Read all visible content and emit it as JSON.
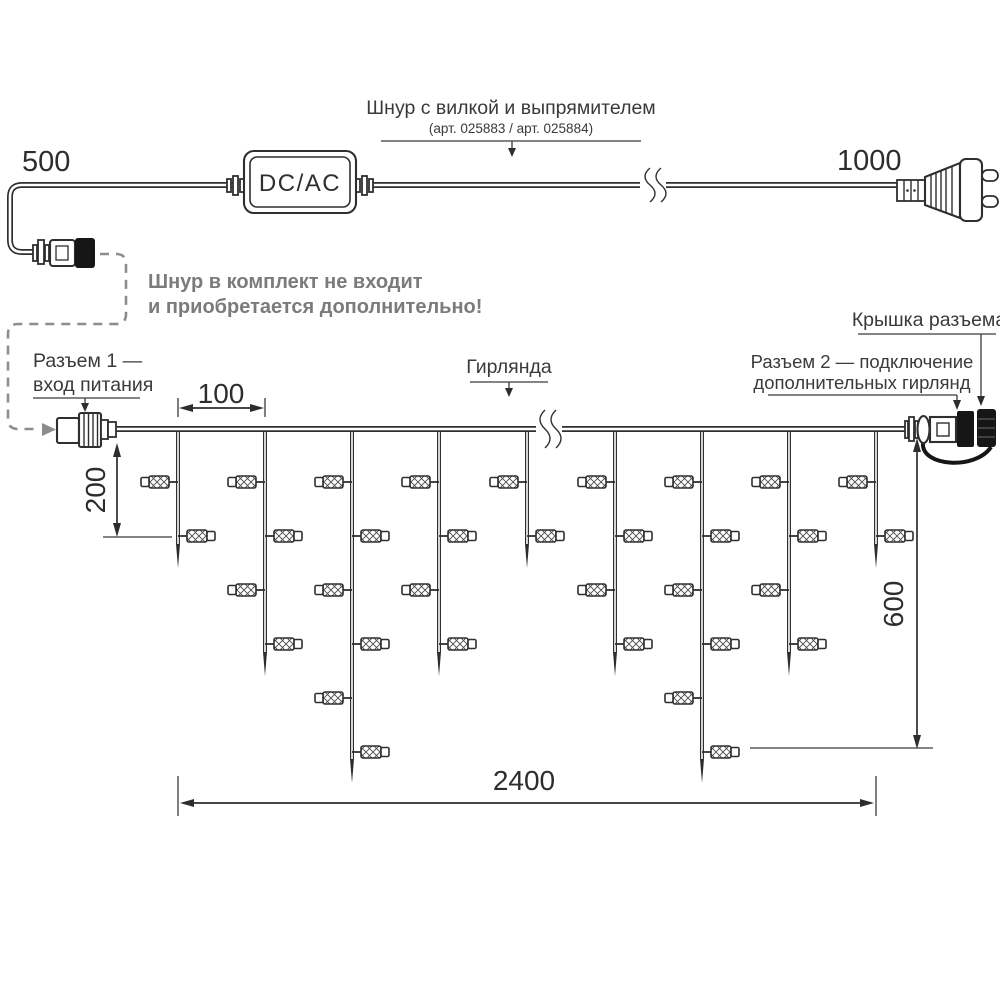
{
  "labels": {
    "cord_title": "Шнур с вилкой и выпрямителем",
    "cord_articles": "(арт. 025883 / арт. 025884)",
    "adapter": "DC/AC",
    "note_line1": "Шнур в комплект не входит",
    "note_line2": "и приобретается дополнительно!",
    "connector1_line1": "Разъем 1 —",
    "connector1_line2": "вход питания",
    "garland": "Гирлянда",
    "connector2_line1": "Разъем 2 — подключение",
    "connector2_line2": "дополнительных гирлянд",
    "cap": "Крышка разъема"
  },
  "dimensions": {
    "cord_left_mm": "500",
    "cord_right_mm": "1000",
    "drop_spacing_mm": "100",
    "short_drop_mm": "200",
    "long_drop_mm": "600",
    "garland_length_mm": "2400"
  },
  "colors": {
    "line": "#2f2f2f",
    "note_gray": "#7b7b7b",
    "dashed_gray": "#8c8c8c",
    "background": "#ffffff"
  }
}
